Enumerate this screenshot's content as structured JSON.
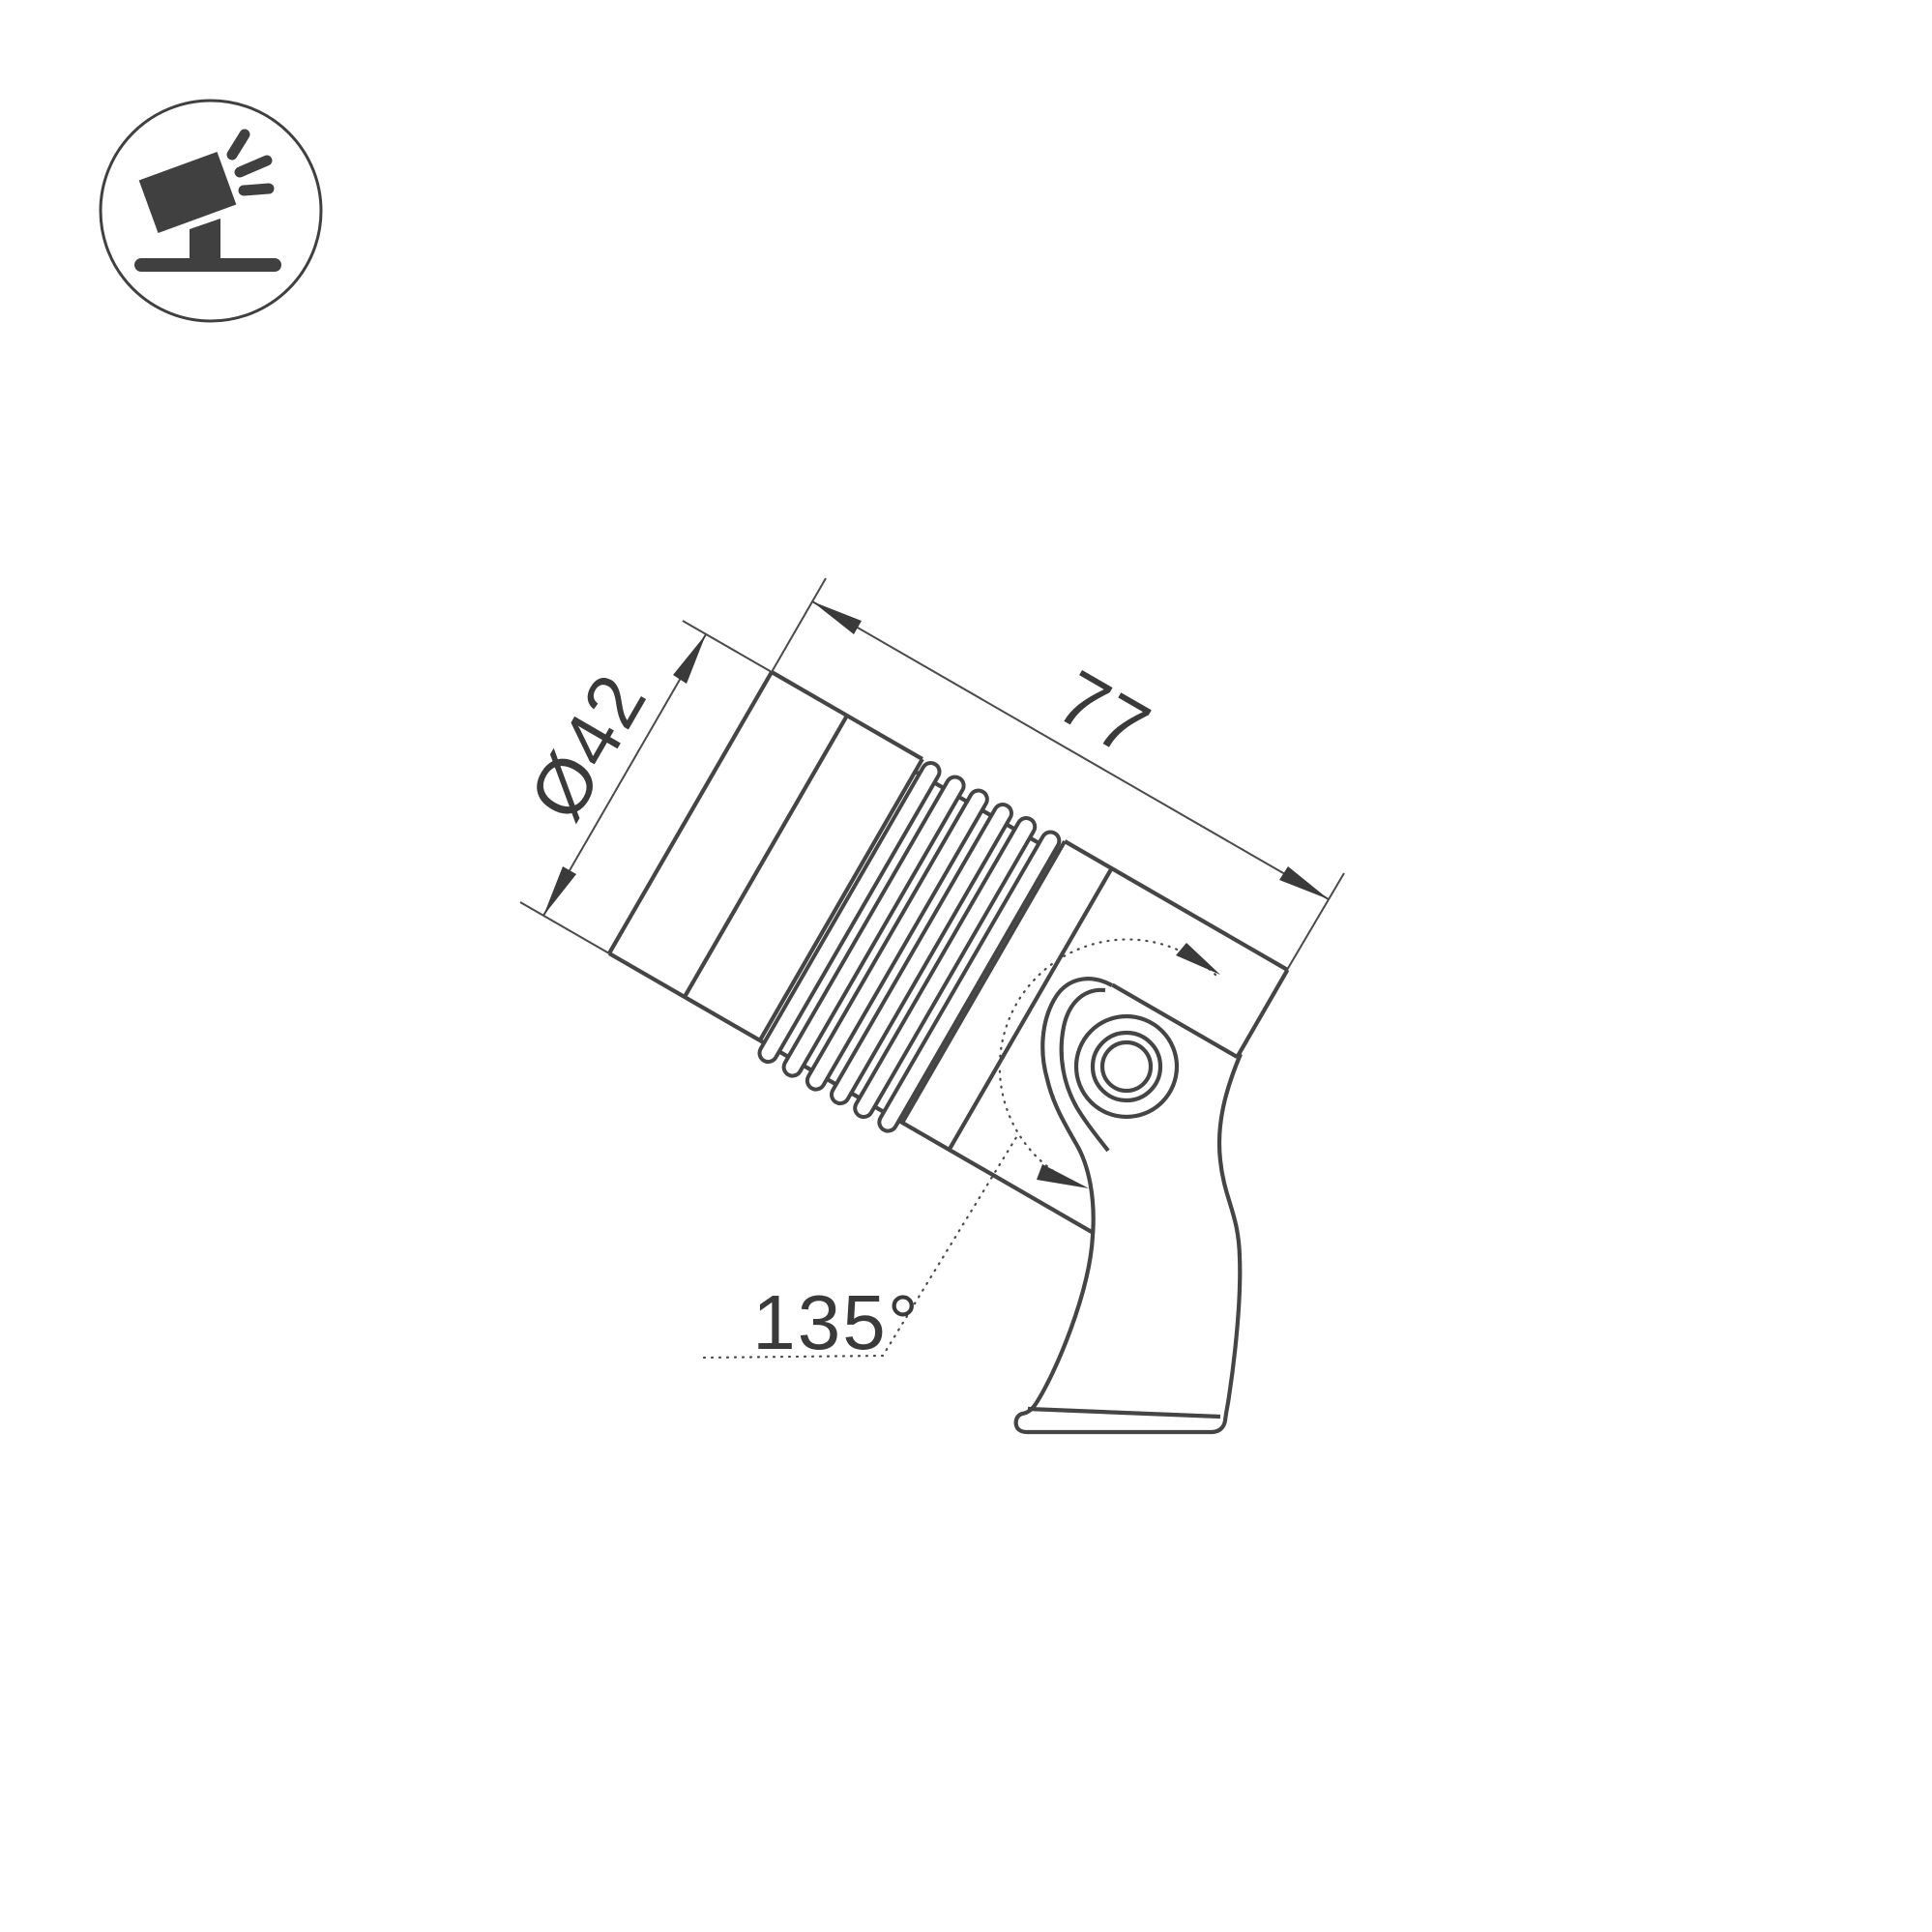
{
  "page": {
    "background_color": "#ffffff",
    "line_color": "#454545",
    "dim_line_color": "#4a4a4a",
    "dark_color": "#3a3a3a",
    "icon_color": "#404040"
  },
  "icon": {
    "name": "tilted-spotlight-on-stand-icon",
    "description": "circled pictogram of a tilted ground spotlight emitting light rays"
  },
  "drawing": {
    "type": "technical-dimension-drawing",
    "subject": "LED ground spotlight with pivot bracket, tilted 30 degrees",
    "dimensions": {
      "diameter_label": "Ø42",
      "length_label": "77",
      "angle_label": "135°"
    }
  }
}
